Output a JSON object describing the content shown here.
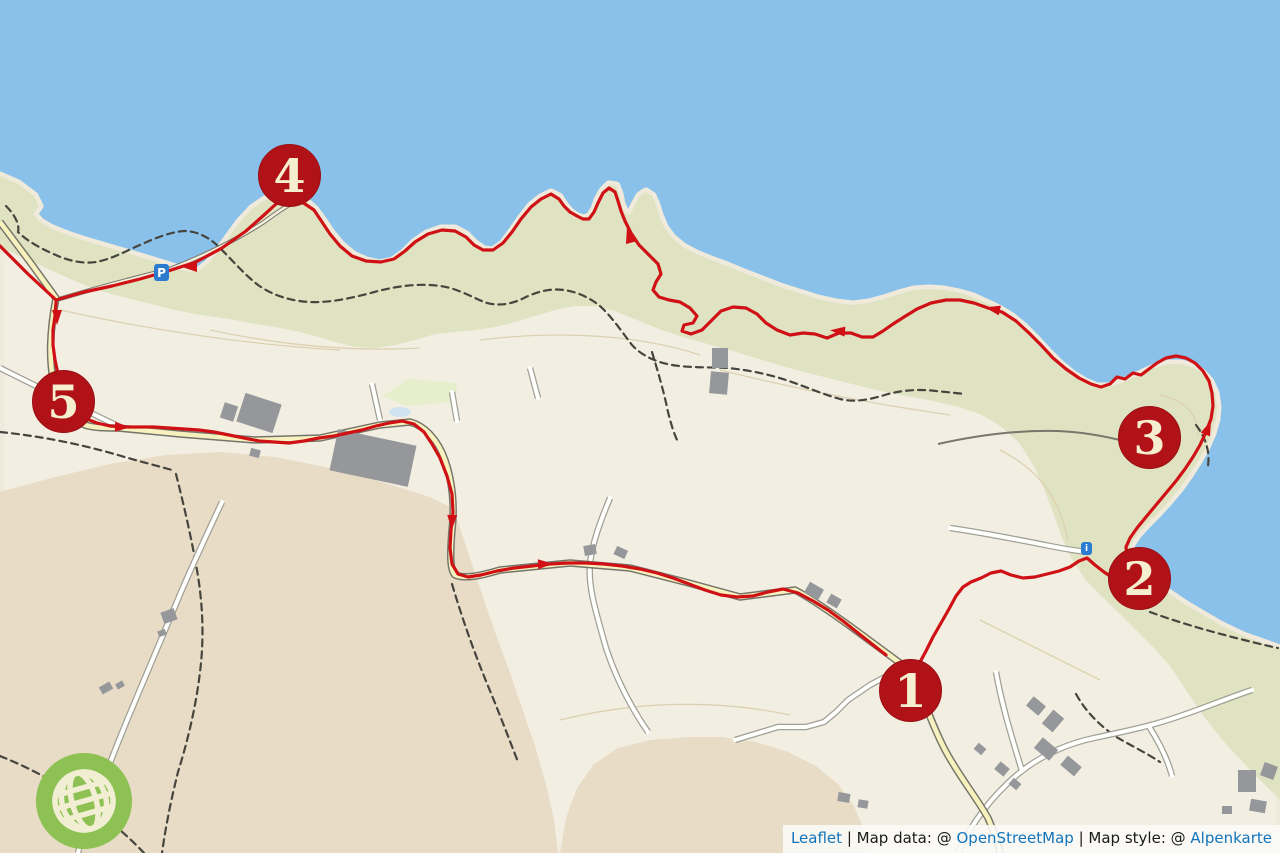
{
  "map": {
    "markers": [
      {
        "label": "1",
        "x": 911,
        "y": 691
      },
      {
        "label": "2",
        "x": 1140,
        "y": 579
      },
      {
        "label": "3",
        "x": 1150,
        "y": 438
      },
      {
        "label": "4",
        "x": 290,
        "y": 176
      },
      {
        "label": "5",
        "x": 64,
        "y": 402
      }
    ],
    "pois": [
      {
        "type": "parking",
        "label": "P",
        "x": 162,
        "y": 273
      },
      {
        "type": "info",
        "label": "i",
        "x": 1087,
        "y": 549
      }
    ],
    "colors": {
      "water": "#8ac1ea",
      "land": "#f2efe2",
      "shore": "#efeadb",
      "coast_green": "#dfe3c1",
      "field_green": "#e6eecb",
      "farmland": "#e9dcc7",
      "pond": "#cfe4f0",
      "contour": "#ddd0b0",
      "path_dash": "#45453e",
      "track": "#77776a",
      "road_casing": "#a0a096",
      "road_fill": "#fffffe",
      "yroad_casing": "#74746a",
      "road_yellow": "#f6f1bd",
      "building": "#95979a",
      "route": "#cf1116",
      "marker_bg": "#b11217",
      "marker_rim": "#990f13",
      "marker_text": "#f5eecf",
      "poi_blue": "#2b7cd0",
      "globe_green": "#8dc153",
      "globe_lines": "#f2eed3",
      "link_blue": "#1274bb",
      "attr_bg": "rgba(250,250,248,0.88)"
    }
  },
  "attribution": {
    "leaflet": "Leaflet",
    "separator": "|",
    "map_data_label": "Map data: @",
    "openstreetmap": "OpenStreetMap",
    "map_style_label": "Map style: @",
    "alpenkarte": "Alpenkarte"
  }
}
